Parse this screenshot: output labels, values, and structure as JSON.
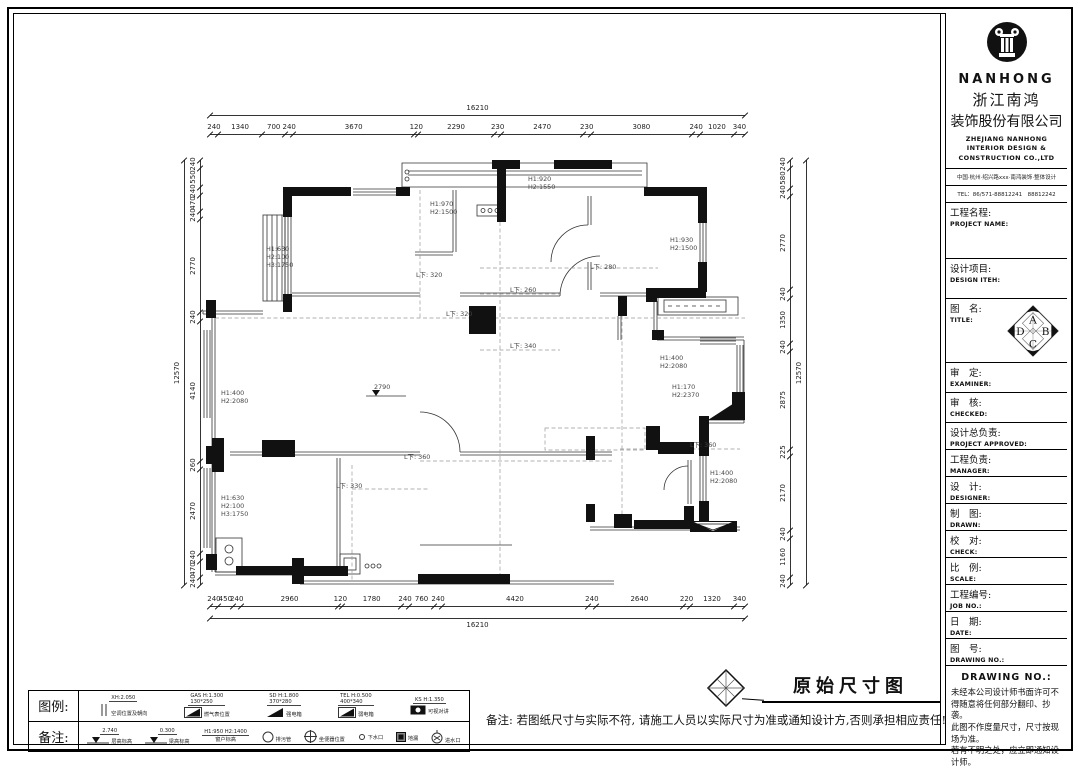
{
  "titleblock": {
    "logo_text": "NANHONG",
    "company_cn_1": "浙江南鸿",
    "company_cn_2": "装饰股份有限公司",
    "company_en_lines": [
      "ZHEJIANG NANHONG",
      "INTERIOR DESIGN &",
      "CONSTRUCTION CO.,LTD"
    ],
    "address": "中国·杭州·绍兴路xxx·南鸿装饰·整体设计",
    "tel": "TEL：86/571-88812241　88812242",
    "fields": [
      {
        "cn": "工程名程:",
        "en": "PROJECT NAME:"
      },
      {
        "cn": "设计项目:",
        "en": "DESIGN ITEH:"
      },
      {
        "cn": "图　名:",
        "en": "TITLE:"
      },
      {
        "cn": "审　定:",
        "en": "EXAMINER:"
      },
      {
        "cn": "审　核:",
        "en": "CHECKED:"
      },
      {
        "cn": "设计总负责:",
        "en": "PROJECT APPROVED:"
      },
      {
        "cn": "工程负责:",
        "en": "MANAGER:"
      },
      {
        "cn": "设　计:",
        "en": "DESIGNER:"
      },
      {
        "cn": "制　图:",
        "en": "DRAWN:"
      },
      {
        "cn": "校　对:",
        "en": "CHECK:"
      },
      {
        "cn": "比　例:",
        "en": "SCALE:"
      },
      {
        "cn": "工程编号:",
        "en": "JOB NO.:"
      },
      {
        "cn": "日　期:",
        "en": "DATE:"
      },
      {
        "cn": "图　号:",
        "en": "DRAWING NO.:"
      }
    ],
    "compass_letters": [
      "A",
      "B",
      "C",
      "D"
    ],
    "notice_title": "DRAWING NO.:",
    "notice_lines": [
      "未经本公司设计师书面许可不得随意将任何部分翻印、抄袭。",
      "此图不作度量尺寸，尺寸按现场为准。",
      "若有不明之处，应立即通知设计师。"
    ]
  },
  "footer": {
    "legend_label": "图例:",
    "notes_label": "备注:",
    "legend_items": [
      {
        "code": "XH:2.050",
        "size": "",
        "label": "空调位置及朝向",
        "sym": "ac-unit"
      },
      {
        "code": "GAS H:1.300",
        "size": "130*250",
        "label": "燃气表位置",
        "sym": "gas-meter"
      },
      {
        "code": "SD H:1.800",
        "size": "370*280",
        "label": "强电箱",
        "sym": "power-box"
      },
      {
        "code": "TEL H:0.500",
        "size": "400*340",
        "label": "弱电箱",
        "sym": "telecom-box"
      },
      {
        "code": "KS H:1.350",
        "size": "",
        "label": "可视对讲",
        "sym": "intercom"
      }
    ],
    "note_items": [
      {
        "code": "2.740",
        "label": "层高标高",
        "sym": "level-mark"
      },
      {
        "code": "0.300",
        "label": "梁高标高",
        "sym": "level-mark"
      },
      {
        "code": "H1:950 H2:1400",
        "label": "窗户标高",
        "sym": "text-only"
      },
      {
        "code": "",
        "label": "排污管",
        "sym": "circle"
      },
      {
        "code": "",
        "label": "坐便器位置",
        "sym": "crosshair"
      },
      {
        "code": "",
        "label": "下水口",
        "sym": "small-circle"
      },
      {
        "code": "",
        "label": "地漏",
        "sym": "drain-square"
      },
      {
        "code": "",
        "label": "进水口",
        "sym": "inlet"
      }
    ],
    "note_text": "备注: 若图纸尺寸与实际不符, 请施工人员以实际尺寸为准或通知设计方,否则承担相应责任!",
    "drawing_title": "原始尺寸图"
  },
  "dims": {
    "top_total": 16210,
    "top": [
      240,
      1340,
      700,
      240,
      3670,
      120,
      2290,
      230,
      2470,
      230,
      3080,
      240,
      1020,
      340
    ],
    "bottom": [
      240,
      450,
      240,
      2960,
      120,
      1780,
      240,
      760,
      240,
      4420,
      240,
      2640,
      220,
      1320,
      340
    ],
    "bottom_total": 16210,
    "left": [
      240,
      550,
      240,
      470,
      240,
      2770,
      240,
      4140,
      260,
      2470,
      240,
      470,
      240
    ],
    "left_total": 12570,
    "right": [
      240,
      580,
      240,
      2770,
      240,
      1350,
      240,
      2875,
      225,
      2170,
      240,
      1160,
      240
    ],
    "right_total": 12570
  },
  "plan": {
    "annotations": [
      {
        "t": "H1:630",
        "x": 266,
        "y": 251
      },
      {
        "t": "H2:100",
        "x": 266,
        "y": 259
      },
      {
        "t": "H3:1750",
        "x": 266,
        "y": 267
      },
      {
        "t": "H1:970",
        "x": 430,
        "y": 206
      },
      {
        "t": "H2:1500",
        "x": 430,
        "y": 214
      },
      {
        "t": "H1:920",
        "x": 528,
        "y": 181
      },
      {
        "t": "H2:1550",
        "x": 528,
        "y": 189
      },
      {
        "t": "H1:930",
        "x": 670,
        "y": 242
      },
      {
        "t": "H2:1500",
        "x": 670,
        "y": 250
      },
      {
        "t": "H1:400",
        "x": 221,
        "y": 395
      },
      {
        "t": "H2:2080",
        "x": 221,
        "y": 403
      },
      {
        "t": "2790",
        "x": 374,
        "y": 389
      },
      {
        "t": "H1:630",
        "x": 221,
        "y": 500
      },
      {
        "t": "H2:100",
        "x": 221,
        "y": 508
      },
      {
        "t": "H3:1750",
        "x": 221,
        "y": 516
      },
      {
        "t": "H1:400",
        "x": 660,
        "y": 360
      },
      {
        "t": "H2:2080",
        "x": 660,
        "y": 368
      },
      {
        "t": "H1:170",
        "x": 672,
        "y": 389
      },
      {
        "t": "H2:2370",
        "x": 672,
        "y": 397
      },
      {
        "t": "H1:400",
        "x": 710,
        "y": 475
      },
      {
        "t": "H2:2080",
        "x": 710,
        "y": 483
      },
      {
        "t": "L下: 320",
        "x": 416,
        "y": 277
      },
      {
        "t": "L下: 320",
        "x": 446,
        "y": 316
      },
      {
        "t": "L下: 280",
        "x": 590,
        "y": 269
      },
      {
        "t": "L下: 260",
        "x": 510,
        "y": 292
      },
      {
        "t": "L下: 340",
        "x": 510,
        "y": 348
      },
      {
        "t": "L下: 360",
        "x": 404,
        "y": 459
      },
      {
        "t": "L下: 330",
        "x": 336,
        "y": 488
      },
      {
        "t": "L下: 360",
        "x": 690,
        "y": 447
      }
    ]
  }
}
